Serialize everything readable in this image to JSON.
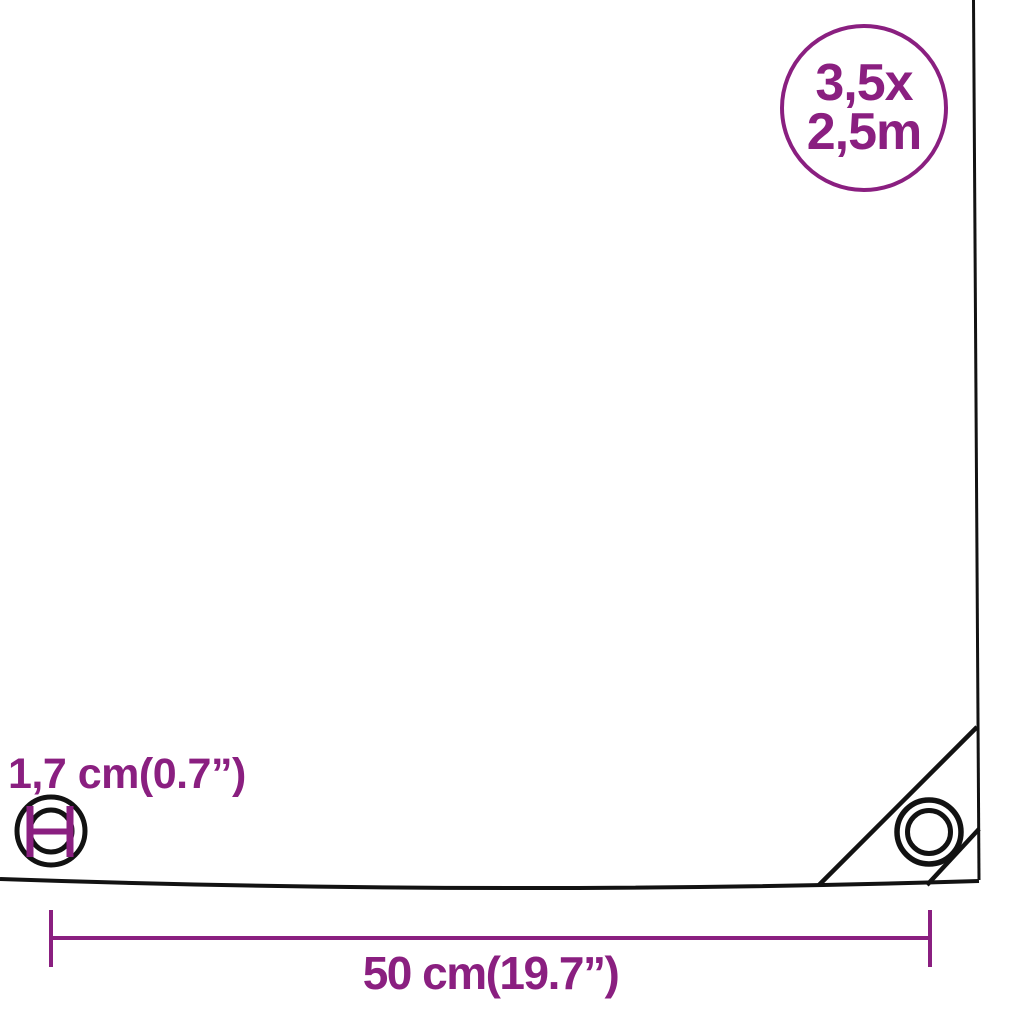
{
  "badge": {
    "line1": "3,5x",
    "line2": "2,5m"
  },
  "annotations": {
    "grommet_diameter_label": "1,7 cm(0.7”)",
    "corner_distance_label": "50 cm(19.7”)"
  },
  "icons": {
    "corner_grommet": "corner-grommet-icon",
    "grommet_detail": "grommet-detail-icon",
    "size_badge": "size-badge-circle"
  },
  "colors": {
    "accent": "#8A1F80",
    "outline": "#121212",
    "background": "#FFFFFF"
  }
}
